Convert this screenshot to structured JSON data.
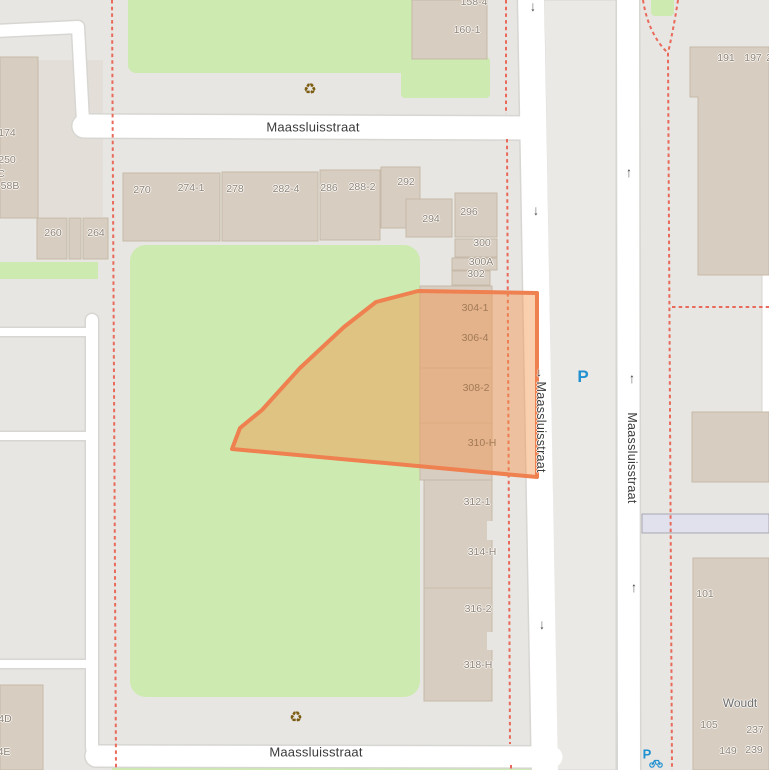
{
  "map": {
    "street_labels": {
      "top": {
        "text": "Maassluisstraat",
        "x": 313,
        "y": 127
      },
      "bottom": {
        "text": "Maassluisstraat",
        "x": 316,
        "y": 752
      },
      "west_vertical": {
        "oneway_arrow": "→",
        "text": "Maassluisstraat",
        "x": 541,
        "y": 420
      },
      "east_vertical": {
        "text": "Maassluisstraat",
        "x": 632,
        "y": 458
      },
      "woudt": {
        "text": "Woudt",
        "x": 740,
        "y": 703
      }
    },
    "house_numbers": [
      {
        "text": "270",
        "x": 142,
        "y": 190
      },
      {
        "text": "274-1",
        "x": 191,
        "y": 188
      },
      {
        "text": "278",
        "x": 235,
        "y": 189
      },
      {
        "text": "282-4",
        "x": 286,
        "y": 189
      },
      {
        "text": "286",
        "x": 329,
        "y": 188
      },
      {
        "text": "288-2",
        "x": 362,
        "y": 187
      },
      {
        "text": "292",
        "x": 406,
        "y": 182
      },
      {
        "text": "294",
        "x": 431,
        "y": 219
      },
      {
        "text": "296",
        "x": 469,
        "y": 212
      },
      {
        "text": "300",
        "x": 482,
        "y": 243
      },
      {
        "text": "300A",
        "x": 481,
        "y": 262
      },
      {
        "text": "302",
        "x": 476,
        "y": 274
      },
      {
        "text": "304-1",
        "x": 475,
        "y": 308,
        "muted": true
      },
      {
        "text": "306-4",
        "x": 475,
        "y": 338,
        "muted": true
      },
      {
        "text": "308-2",
        "x": 476,
        "y": 388,
        "muted": true
      },
      {
        "text": "310-H",
        "x": 482,
        "y": 443,
        "muted": true
      },
      {
        "text": "312-1",
        "x": 477,
        "y": 502
      },
      {
        "text": "314-H",
        "x": 482,
        "y": 552
      },
      {
        "text": "316-2",
        "x": 478,
        "y": 609
      },
      {
        "text": "318-H",
        "x": 478,
        "y": 665
      },
      {
        "text": "158-4",
        "x": 474,
        "y": 2
      },
      {
        "text": "160-1",
        "x": 467,
        "y": 30
      },
      {
        "text": "191",
        "x": 726,
        "y": 58
      },
      {
        "text": "197",
        "x": 753,
        "y": 58
      },
      {
        "text": "2",
        "x": 769,
        "y": 58
      },
      {
        "text": "101",
        "x": 705,
        "y": 594
      },
      {
        "text": "105",
        "x": 709,
        "y": 725
      },
      {
        "text": "237",
        "x": 755,
        "y": 730
      },
      {
        "text": "149",
        "x": 728,
        "y": 751
      },
      {
        "text": "239",
        "x": 754,
        "y": 750
      },
      {
        "text": "174",
        "x": 7,
        "y": 133
      },
      {
        "text": "250",
        "x": 7,
        "y": 160
      },
      {
        "text": "C",
        "x": 1,
        "y": 174
      },
      {
        "text": "58B",
        "x": 10,
        "y": 186
      },
      {
        "text": "260",
        "x": 53,
        "y": 233
      },
      {
        "text": "264",
        "x": 96,
        "y": 233
      },
      {
        "text": "4D",
        "x": 5,
        "y": 719
      },
      {
        "text": "4E",
        "x": 4,
        "y": 752
      }
    ],
    "oneway_arrows": [
      {
        "glyph": "↓",
        "x": 533,
        "y": 6
      },
      {
        "glyph": "↓",
        "x": 536,
        "y": 210
      },
      {
        "glyph": "↓",
        "x": 542,
        "y": 624
      },
      {
        "glyph": "↑",
        "x": 629,
        "y": 172
      },
      {
        "glyph": "↑",
        "x": 632,
        "y": 378
      },
      {
        "glyph": "↑",
        "x": 634,
        "y": 587
      }
    ],
    "amenities": {
      "recycling": {
        "glyph": "♻",
        "positions": [
          {
            "x": 310,
            "y": 89
          },
          {
            "x": 296,
            "y": 717
          }
        ]
      },
      "parking": {
        "label": "P",
        "x": 583,
        "y": 377
      },
      "bicycle_parking": {
        "label": "P",
        "x": 647,
        "y": 754
      }
    },
    "colors": {
      "background": "#e7e6e3",
      "road": "#ffffff",
      "road-casing": "#d7d6d2",
      "median": "#eae9e6",
      "green": "#cdeab0",
      "building": "#d7cdc1",
      "building-outline": "#c6b9a7",
      "parcel": "#e3dfd8",
      "selection-fill": "rgba(243,148,76,0.45)",
      "selection-border": "#ef8050",
      "boundary-dash": "#e96a5a",
      "transit-band": "#e0e1ed",
      "housenumber": "#8e8376",
      "parking": "#2090d0",
      "amenity": "#7b5c10"
    }
  }
}
